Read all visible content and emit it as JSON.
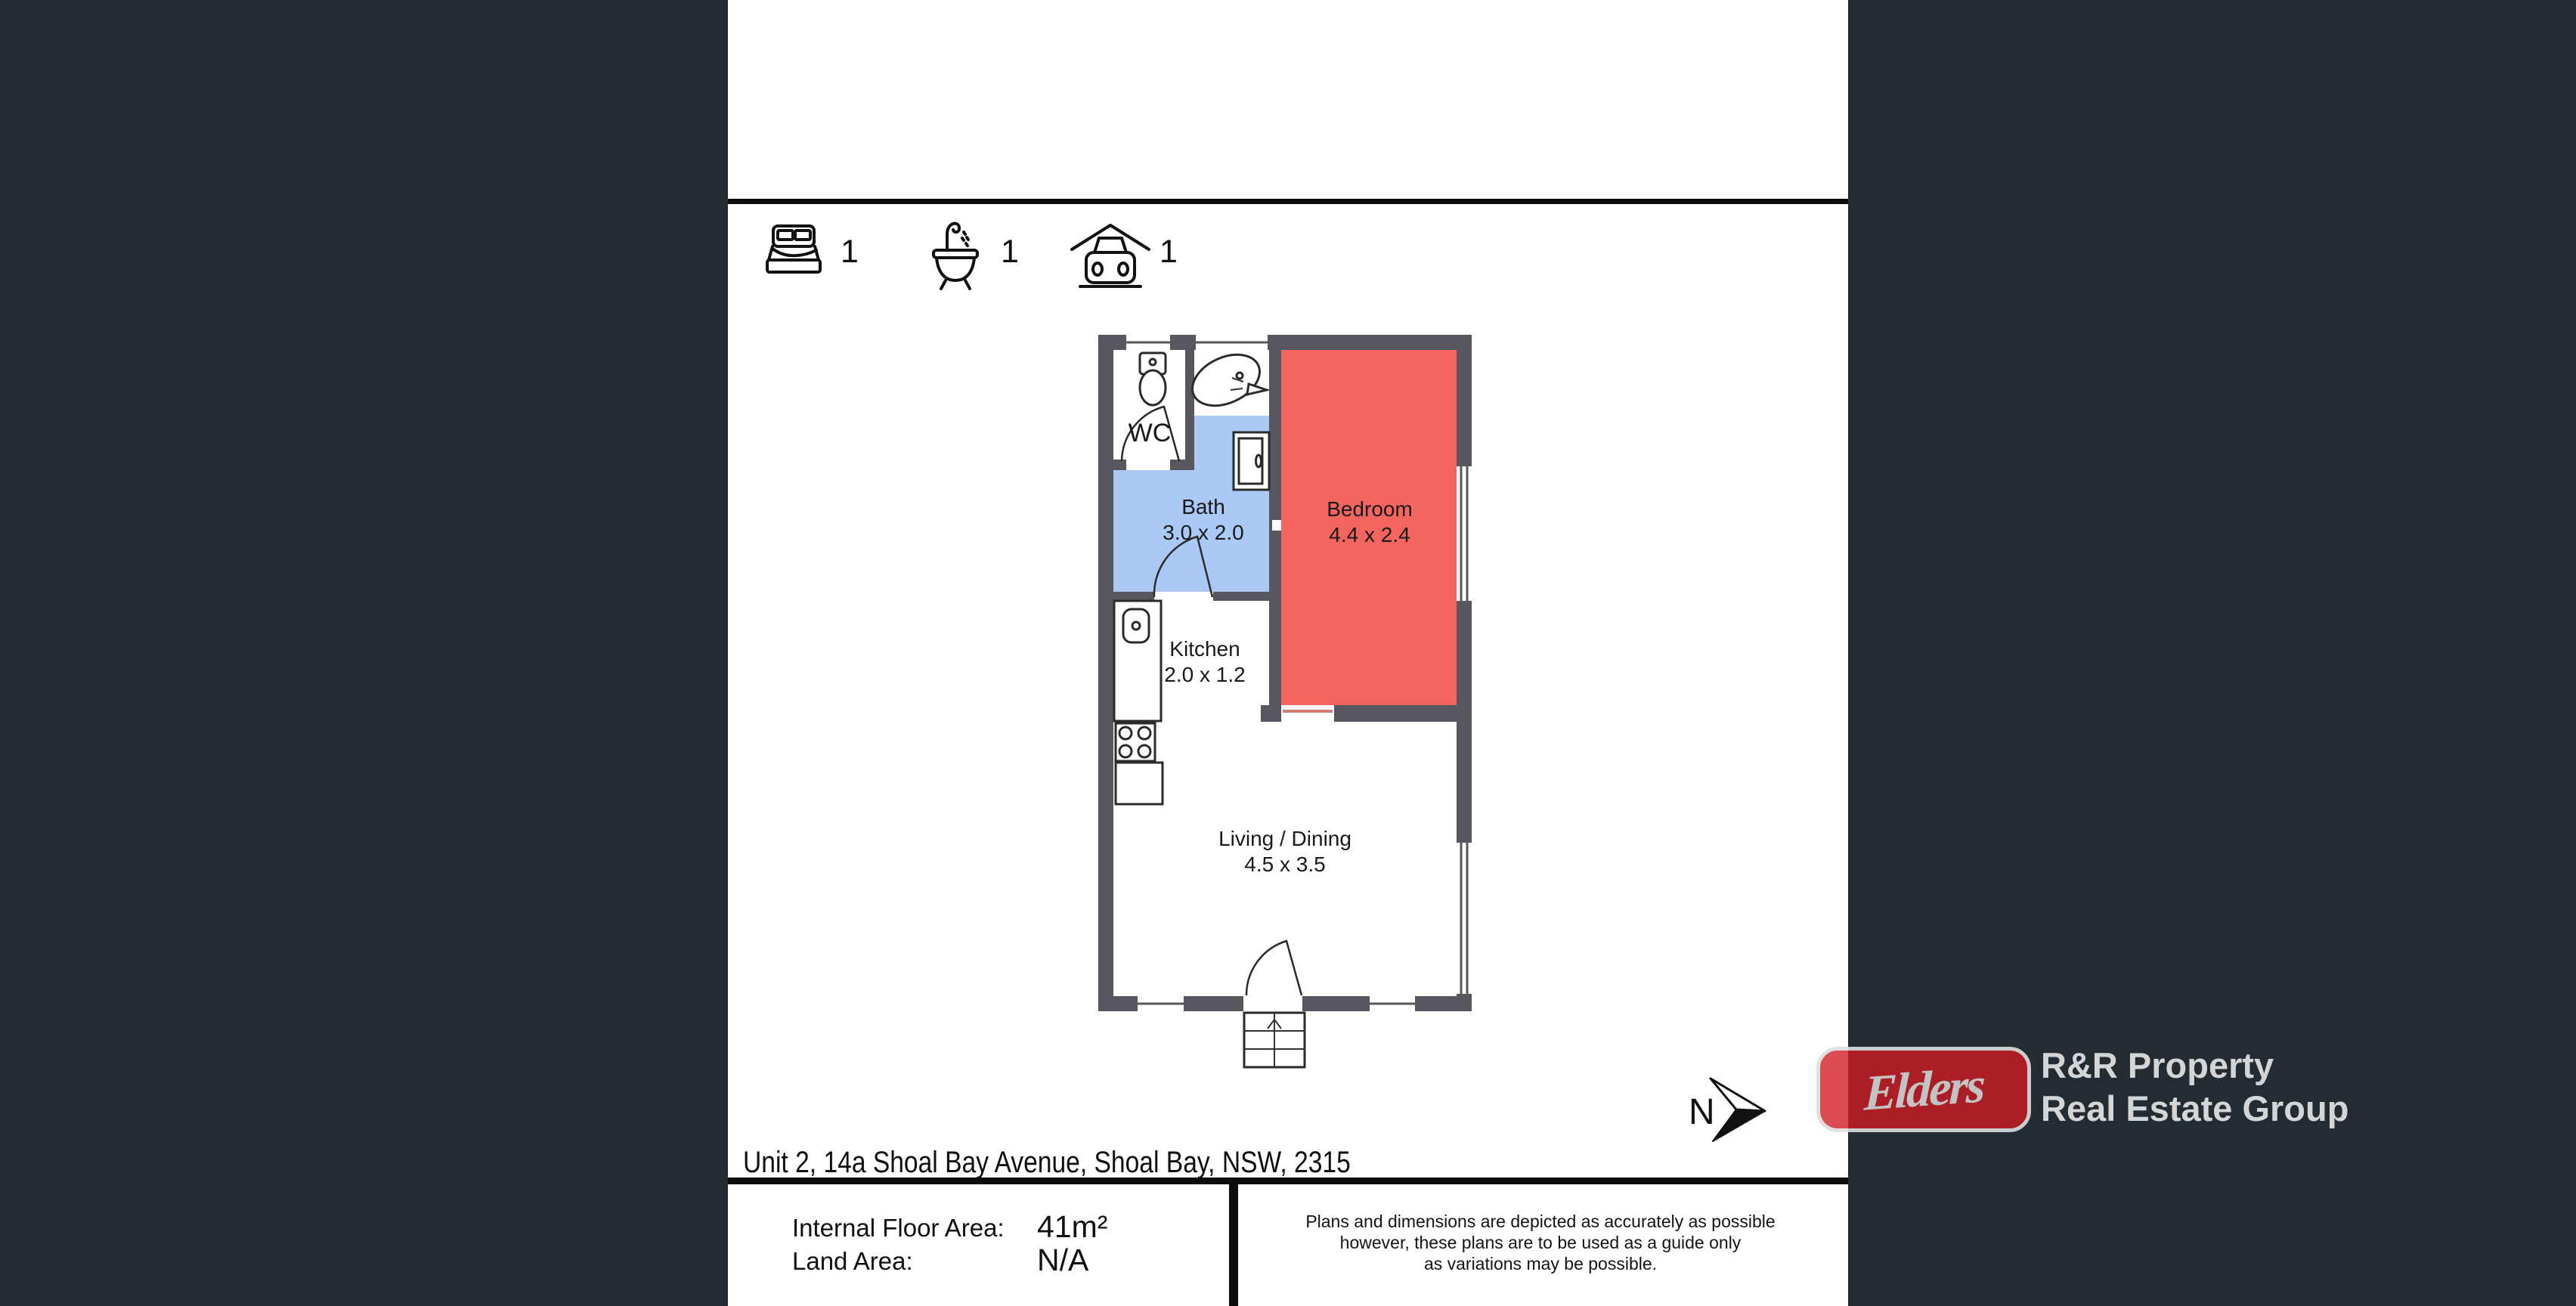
{
  "colors": {
    "background": "#232b33",
    "sheet": "#ffffff",
    "divider": "#0c0c0c",
    "wall": "#57575f",
    "bedroom": "#f4655f",
    "bath": "#abc9f5",
    "elders_red": "rgba(209,28,36,0.87)",
    "logo_border": "#dedede",
    "brand_text": "#d3d5d7"
  },
  "summary": {
    "beds": {
      "icon": "bed-icon",
      "count": "1"
    },
    "baths": {
      "icon": "bath-icon",
      "count": "1"
    },
    "cars": {
      "icon": "carport-icon",
      "count": "1"
    }
  },
  "plan": {
    "north_label": "N",
    "rooms": {
      "wc": {
        "name": "WC"
      },
      "bath": {
        "name": "Bath",
        "dims": "3.0 x 2.0"
      },
      "bedroom": {
        "name": "Bedroom",
        "dims": "4.4 x 2.4"
      },
      "kitchen": {
        "name": "Kitchen",
        "dims": "2.0 x 1.2"
      },
      "living": {
        "name": "Living / Dining",
        "dims": "4.5 x 3.5"
      }
    }
  },
  "footer": {
    "address": "Unit 2, 14a Shoal Bay Avenue, Shoal Bay, NSW, 2315",
    "internal_area_label": "Internal Floor Area:",
    "internal_area_value": "41m²",
    "land_area_label": "Land Area:",
    "land_area_value": "N/A",
    "disclaimer_line1": "Plans and dimensions are depicted as accurately as possible",
    "disclaimer_line2": "however, these plans are to be used as a guide only",
    "disclaimer_line3": "as variations may be possible."
  },
  "brand": {
    "logo_text": "Elders",
    "line1": "R&R Property",
    "line2": "Real Estate Group"
  }
}
